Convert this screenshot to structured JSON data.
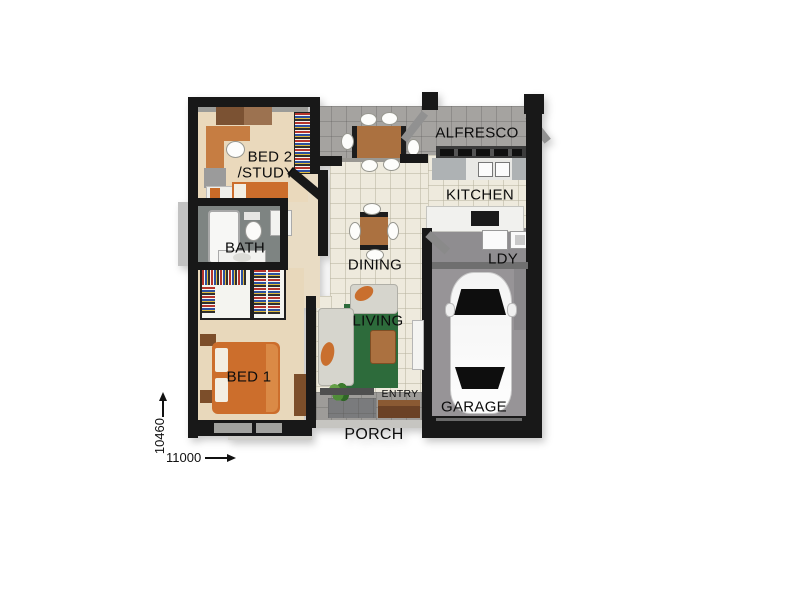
{
  "image_type": "3d-floor-plan-top-view",
  "labels": {
    "bed2_line1": "BED 2",
    "bed2_line2": "/STUDY",
    "bath": "BATH",
    "bed1": "BED 1",
    "alfresco": "ALFRESCO",
    "kitchen": "KITCHEN",
    "laundry": "LDY",
    "dining": "DINING",
    "living": "LIVING",
    "entry": "ENTRY",
    "garage": "GARAGE",
    "porch": "PORCH"
  },
  "dimensions": {
    "vertical_mm": "10460",
    "horizontal_mm": "11000"
  },
  "rooms": [
    "BED 2 /STUDY",
    "BATH",
    "BED 1",
    "ALFRESCO",
    "KITCHEN",
    "LDY",
    "DINING",
    "LIVING",
    "ENTRY",
    "GARAGE",
    "PORCH"
  ],
  "colors": {
    "wall": "#181818",
    "bedroom_floor": "#ead9bc",
    "tile_floor": "#eeeadd",
    "deck_floor": "#a5a3a0",
    "bath_floor": "#7e8482",
    "laundry_floor": "#8f8d90",
    "garage_floor": "#979497",
    "porch_floor": "#9e9c99",
    "rug_green": "#2d6b3b",
    "bed_orange": "#cc6e2c",
    "timber_brown": "#ab7140",
    "sofa_grey": "#d6d5cd",
    "bench_grey": "#aeb2b4"
  }
}
